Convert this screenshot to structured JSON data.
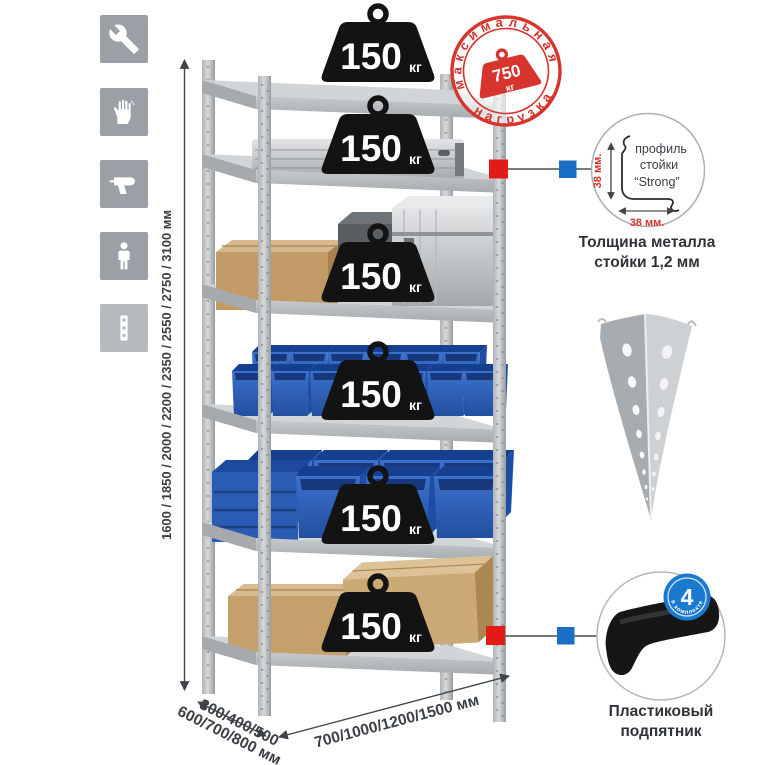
{
  "sidebar": {
    "icons": [
      {
        "name": "wrench-icon"
      },
      {
        "name": "gloves-icon"
      },
      {
        "name": "drill-icon"
      },
      {
        "name": "person-icon"
      },
      {
        "name": "perforated-post-icon"
      }
    ]
  },
  "rack": {
    "shelf_count": 6,
    "shelf_load": "150",
    "shelf_load_unit": "кг"
  },
  "stamp": {
    "arc_top": "максимальная",
    "arc_bottom": "нагрузка",
    "value": "750",
    "unit": "кг"
  },
  "dimensions": {
    "height": "1600 / 1850 / 2000 / 2200 / 2350 / 2550 / 2750 / 3100 мм",
    "depth_line1": "300/400/500",
    "depth_line2": "600/700/800 мм",
    "width": "700/1000/1200/1500 мм"
  },
  "profile_detail": {
    "label_line1": "профиль",
    "label_line2": "стойки",
    "label_line3": "“Strong”",
    "dim_vertical": "38 мм.",
    "dim_horizontal": "38 мм.",
    "caption_line1": "Толщина металла",
    "caption_line2": "стойки 1,2 мм"
  },
  "foot_detail": {
    "badge_value": "4",
    "badge_text": "в комплекте",
    "caption_line1": "Пластиковый",
    "caption_line2": "подпятник"
  },
  "colors": {
    "accent_red": "#d6342c",
    "marker_red": "#e21b16",
    "marker_blue": "#1b6fc5",
    "badge_blue": "#1b79cf",
    "bin_blue": "#2e64bf",
    "steel_gray": "#c3c7ca",
    "icon_gray": "#9aa0a5",
    "text_dark": "#3b4046"
  }
}
